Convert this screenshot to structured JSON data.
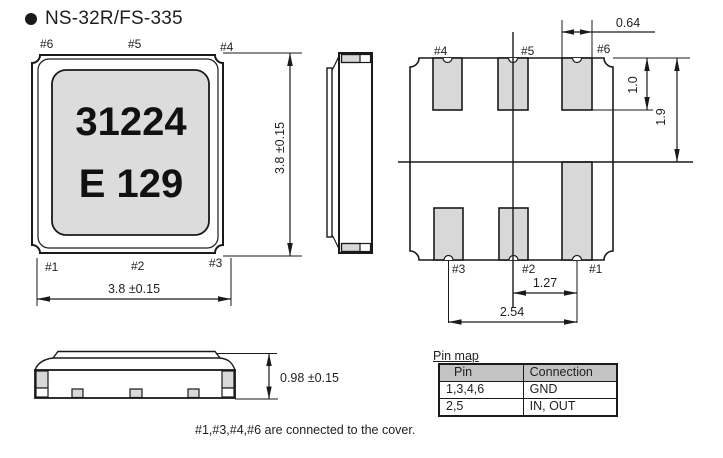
{
  "colors": {
    "line": "#1a1a1a",
    "text": "#1f1f1f",
    "pad": "#d8d8d8",
    "body": "#dcdcdc",
    "header": "#c3c3c3",
    "bg": "#ffffff"
  },
  "title": "NS-32R/FS-335",
  "top_view": {
    "pins_top": [
      "#6",
      "#5",
      "#4"
    ],
    "pins_bottom": [
      "#1",
      "#2",
      "#3"
    ],
    "marking": [
      "31224",
      "E 129"
    ],
    "dim_height": "3.8 ±0.15",
    "dim_width": "3.8 ±0.15"
  },
  "bottom_view": {
    "pins_top": [
      "#4",
      "#5",
      "#6"
    ],
    "pins_bottom": [
      "#3",
      "#2",
      "#1"
    ],
    "dim_pad_width": "0.64",
    "dim_pad_height": "1.0",
    "dim_half_height": "1.9",
    "dim_pitch": "1.27",
    "dim_span": "2.54"
  },
  "front_view": {
    "dim_height": "0.98 ±0.15"
  },
  "pin_map": {
    "caption": "Pin map",
    "headers": [
      "Pin",
      "Connection"
    ],
    "rows": [
      [
        "1,3,4,6",
        "GND"
      ],
      [
        "2,5",
        "IN, OUT"
      ]
    ]
  },
  "footnote": "#1,#3,#4,#6 are connected to the cover."
}
